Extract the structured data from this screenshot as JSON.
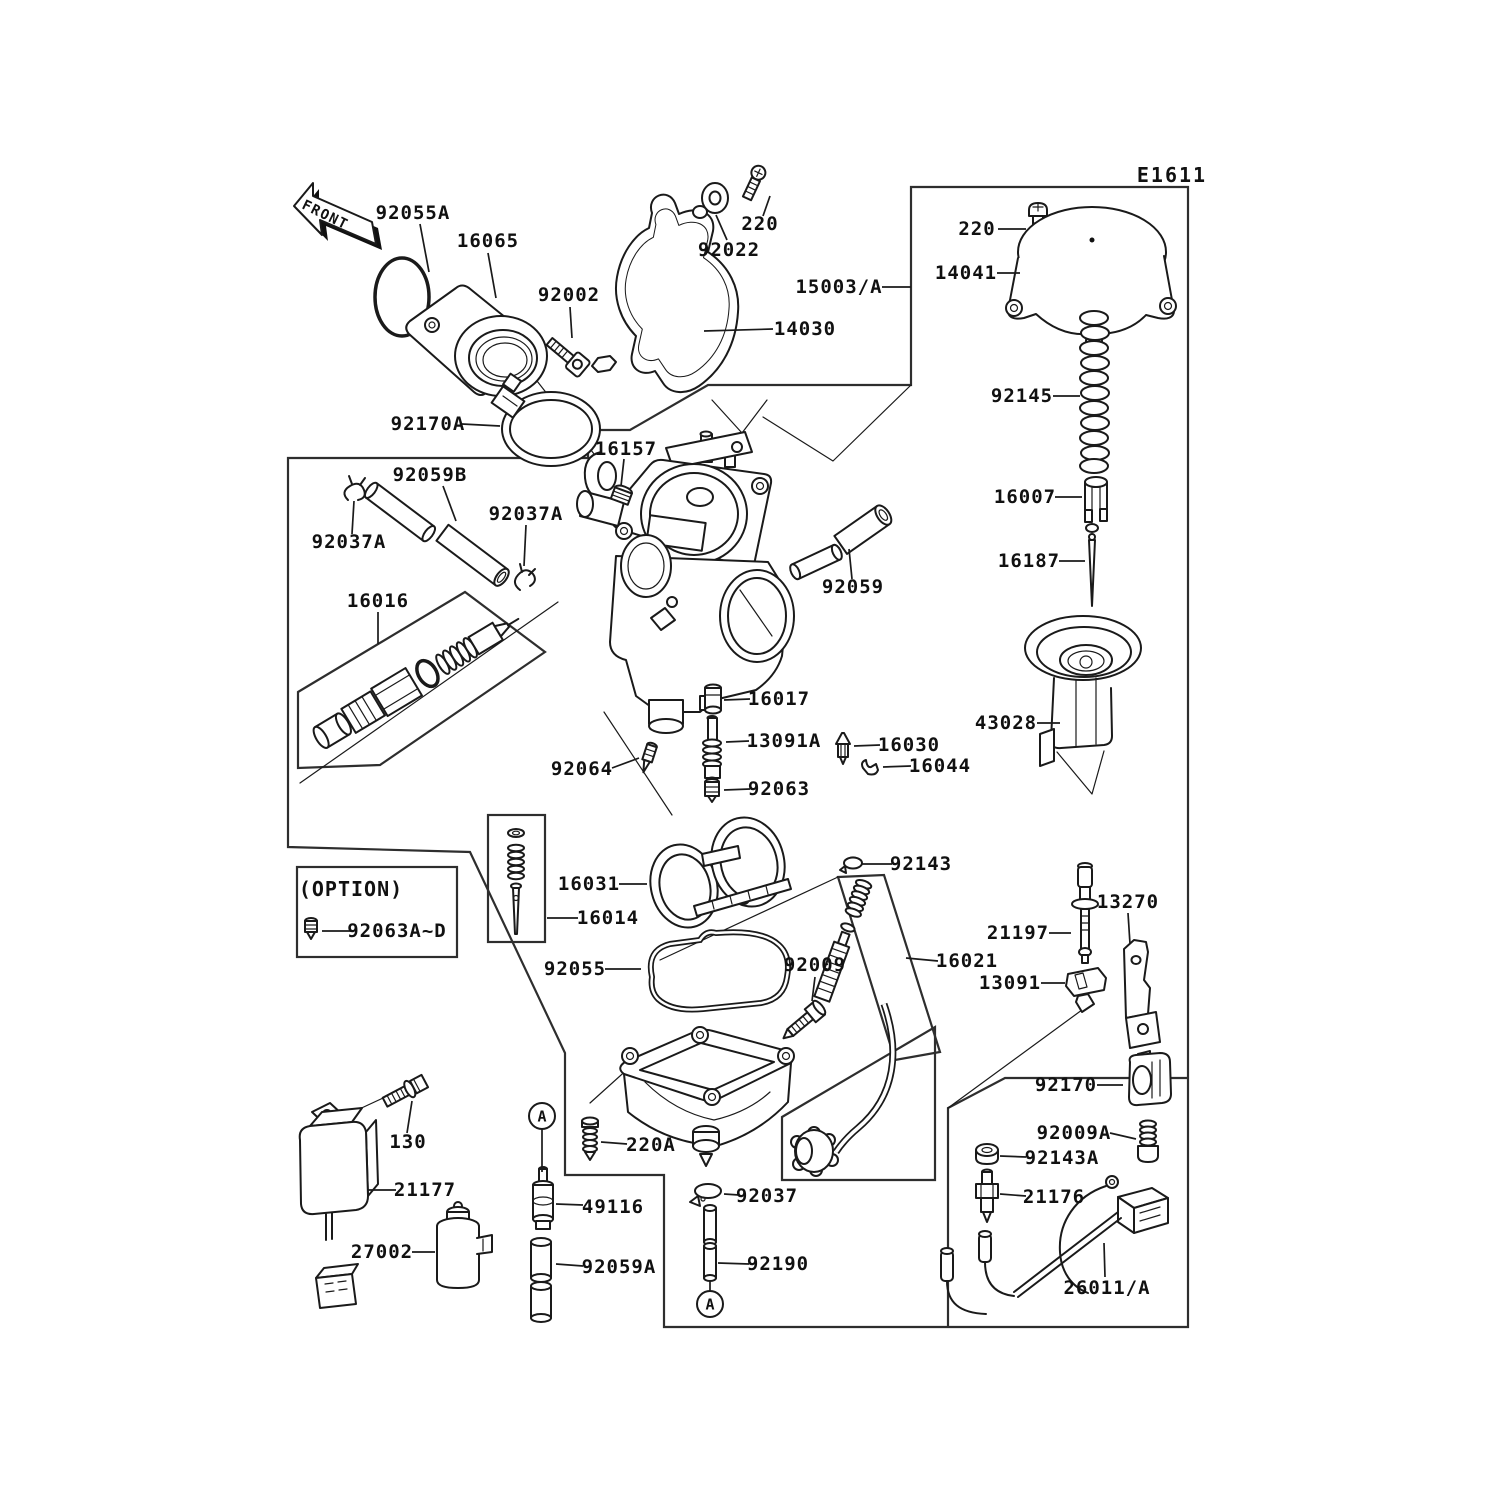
{
  "diagram": {
    "code": "E1611",
    "front_arrow_label": "FRONT",
    "option_panel": {
      "label": "(OPTION)"
    },
    "detail_markers": [
      {
        "letter": "A",
        "x": 542,
        "y": 1116,
        "leader": [
          542,
          1129,
          542,
          1172
        ]
      },
      {
        "letter": "A",
        "x": 710,
        "y": 1304,
        "leader": [
          710,
          1291,
          710,
          1281
        ]
      }
    ],
    "part_labels": [
      {
        "t": "92055A",
        "x": 413,
        "y": 219,
        "l": [
          420,
          224,
          429,
          272
        ]
      },
      {
        "t": "16065",
        "x": 488,
        "y": 247,
        "l": [
          488,
          253,
          496,
          298
        ]
      },
      {
        "t": "92002",
        "x": 569,
        "y": 301,
        "l": [
          570,
          307,
          572,
          338
        ]
      },
      {
        "t": "92022",
        "x": 729,
        "y": 256,
        "l": [
          727,
          240,
          716,
          215
        ]
      },
      {
        "t": "220",
        "x": 760,
        "y": 230,
        "l": [
          763,
          216,
          770,
          196
        ]
      },
      {
        "t": "14030",
        "x": 805,
        "y": 335,
        "l": [
          773,
          329,
          704,
          331
        ]
      },
      {
        "t": "15003/A",
        "x": 839,
        "y": 293,
        "l": [
          882,
          287,
          911,
          287
        ]
      },
      {
        "t": "92170A",
        "x": 428,
        "y": 430,
        "l": [
          462,
          424,
          500,
          426
        ]
      },
      {
        "t": "220",
        "x": 977,
        "y": 235,
        "l": [
          998,
          229,
          1026,
          229
        ]
      },
      {
        "t": "14041",
        "x": 966,
        "y": 279,
        "l": [
          997,
          273,
          1020,
          273
        ]
      },
      {
        "t": "92145",
        "x": 1022,
        "y": 402,
        "l": [
          1053,
          396,
          1080,
          396
        ]
      },
      {
        "t": "16007",
        "x": 1025,
        "y": 503,
        "l": [
          1055,
          497,
          1082,
          497
        ]
      },
      {
        "t": "16187",
        "x": 1029,
        "y": 567,
        "l": [
          1059,
          561,
          1085,
          561
        ]
      },
      {
        "t": "43028",
        "x": 1006,
        "y": 729,
        "l": [
          1037,
          723,
          1060,
          723
        ]
      },
      {
        "t": "16157",
        "x": 626,
        "y": 455,
        "l": [
          624,
          459,
          621,
          486
        ]
      },
      {
        "t": "92059B",
        "x": 430,
        "y": 481,
        "l": [
          443,
          486,
          456,
          521
        ]
      },
      {
        "t": "92037A",
        "x": 349,
        "y": 548,
        "l": [
          352,
          534,
          354,
          501
        ]
      },
      {
        "t": "92037A",
        "x": 526,
        "y": 520,
        "l": [
          526,
          525,
          524,
          566
        ]
      },
      {
        "t": "16016",
        "x": 378,
        "y": 607,
        "l": [
          378,
          612,
          378,
          644
        ]
      },
      {
        "t": "92059",
        "x": 853,
        "y": 593,
        "l": [
          852,
          579,
          849,
          549
        ]
      },
      {
        "t": "92064",
        "x": 582,
        "y": 775,
        "l": [
          612,
          768,
          639,
          758
        ]
      },
      {
        "t": "16017",
        "x": 779,
        "y": 705,
        "l": [
          750,
          699,
          724,
          700
        ]
      },
      {
        "t": "13091A",
        "x": 784,
        "y": 747,
        "l": [
          749,
          741,
          726,
          742
        ]
      },
      {
        "t": "16030",
        "x": 909,
        "y": 751,
        "l": [
          880,
          745,
          854,
          746
        ]
      },
      {
        "t": "16044",
        "x": 940,
        "y": 772,
        "l": [
          911,
          766,
          883,
          767
        ]
      },
      {
        "t": "92063",
        "x": 779,
        "y": 795,
        "l": [
          750,
          789,
          724,
          790
        ]
      },
      {
        "t": "16031",
        "x": 589,
        "y": 890,
        "l": [
          619,
          884,
          647,
          884
        ]
      },
      {
        "t": "16014",
        "x": 608,
        "y": 924,
        "l": [
          578,
          918,
          547,
          918
        ]
      },
      {
        "t": "92055",
        "x": 575,
        "y": 975,
        "l": [
          605,
          969,
          641,
          969
        ]
      },
      {
        "t": "92009",
        "x": 815,
        "y": 971,
        "l": [
          815,
          977,
          812,
          1001
        ]
      },
      {
        "t": "92143",
        "x": 921,
        "y": 870,
        "l": [
          892,
          864,
          862,
          864
        ]
      },
      {
        "t": "16021",
        "x": 967,
        "y": 967,
        "l": [
          938,
          961,
          906,
          958
        ]
      },
      {
        "t": "21197",
        "x": 1018,
        "y": 939,
        "l": [
          1049,
          933,
          1071,
          933
        ]
      },
      {
        "t": "13270",
        "x": 1128,
        "y": 908,
        "l": [
          1128,
          913,
          1130,
          944
        ]
      },
      {
        "t": "13091",
        "x": 1010,
        "y": 989,
        "l": [
          1041,
          983,
          1065,
          983
        ]
      },
      {
        "t": "92170",
        "x": 1066,
        "y": 1091,
        "l": [
          1097,
          1085,
          1123,
          1085
        ]
      },
      {
        "t": "92009A",
        "x": 1074,
        "y": 1139,
        "l": [
          1110,
          1133,
          1136,
          1139
        ]
      },
      {
        "t": "92143A",
        "x": 1062,
        "y": 1164,
        "l": [
          1026,
          1157,
          1000,
          1156
        ]
      },
      {
        "t": "21176",
        "x": 1054,
        "y": 1203,
        "l": [
          1026,
          1196,
          1000,
          1194
        ]
      },
      {
        "t": "26011/A",
        "x": 1107,
        "y": 1294,
        "l": [
          1105,
          1277,
          1104,
          1243
        ]
      },
      {
        "t": "130",
        "x": 408,
        "y": 1148,
        "l": [
          407,
          1133,
          412,
          1101
        ]
      },
      {
        "t": "21177",
        "x": 425,
        "y": 1196,
        "l": [
          396,
          1190,
          368,
          1190
        ]
      },
      {
        "t": "27002",
        "x": 382,
        "y": 1258,
        "l": [
          412,
          1252,
          435,
          1252
        ]
      },
      {
        "t": "49116",
        "x": 613,
        "y": 1213,
        "l": [
          583,
          1205,
          556,
          1204
        ]
      },
      {
        "t": "92059A",
        "x": 619,
        "y": 1273,
        "l": [
          583,
          1266,
          556,
          1264
        ]
      },
      {
        "t": "220A",
        "x": 651,
        "y": 1151,
        "l": [
          627,
          1144,
          601,
          1142
        ]
      },
      {
        "t": "92037",
        "x": 767,
        "y": 1202,
        "l": [
          739,
          1195,
          724,
          1194
        ]
      },
      {
        "t": "92190",
        "x": 778,
        "y": 1270,
        "l": [
          749,
          1264,
          718,
          1263
        ]
      },
      {
        "t": "92063A~D",
        "x": 397,
        "y": 937,
        "l": [
          352,
          931,
          322,
          931
        ]
      }
    ]
  }
}
